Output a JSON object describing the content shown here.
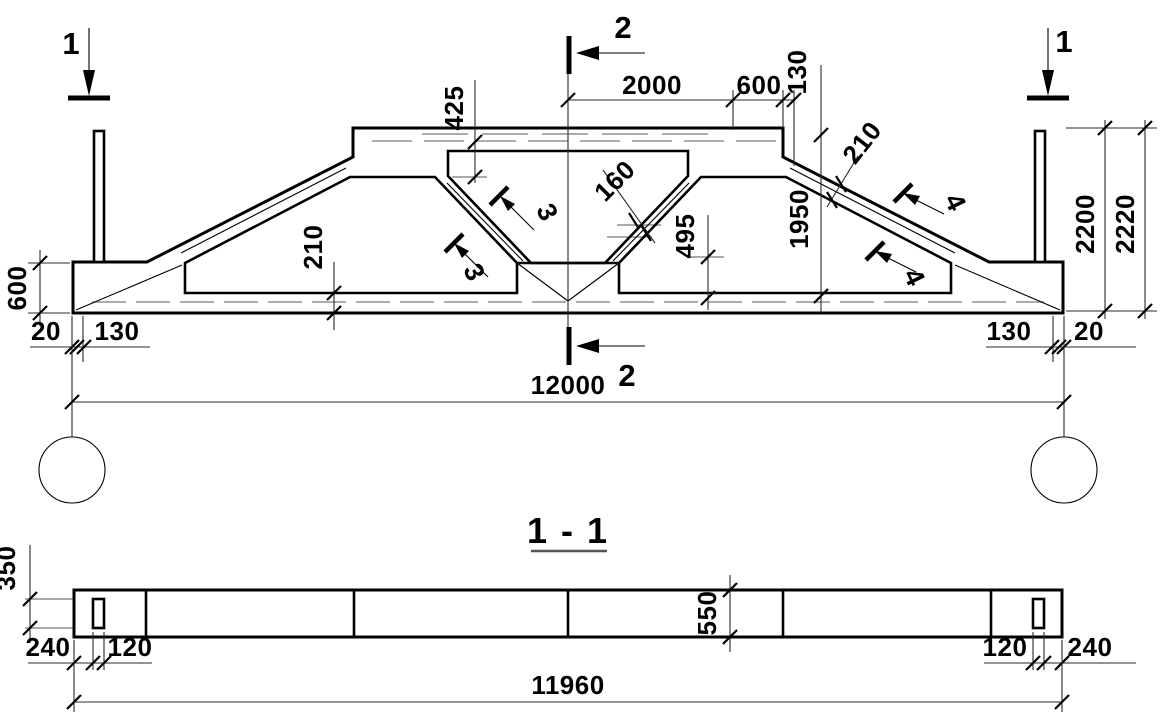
{
  "drawing_type": "reinforced-concrete-truss-elevation-and-section",
  "colors": {
    "line": "#000000",
    "dim_gray": "#8f8f8f",
    "background": "#ffffff"
  },
  "views": {
    "elevation": {
      "section_cut_labels": {
        "cut1": "1",
        "cut2": "2",
        "cut3": "3",
        "cut4": "4"
      },
      "dimensions": {
        "top_chord_depth": "425",
        "top_middle_width": "2000",
        "top_right_offset": "600",
        "top_edge_offset": "130",
        "diagonal_thickness": "160",
        "diagonal_height": "495",
        "chord_thickness": "210",
        "right_height": "1950",
        "total_height": "2200",
        "overall_height": "2220",
        "end_block_height": "600",
        "end_gap": "20",
        "bearing_offset": "130",
        "span": "12000"
      }
    },
    "section_1_1": {
      "title": "1 - 1",
      "dimensions": {
        "hole_height": "350",
        "end_offset": "240",
        "hole_width": "120",
        "beam_width": "550",
        "beam_length": "11960"
      }
    }
  }
}
